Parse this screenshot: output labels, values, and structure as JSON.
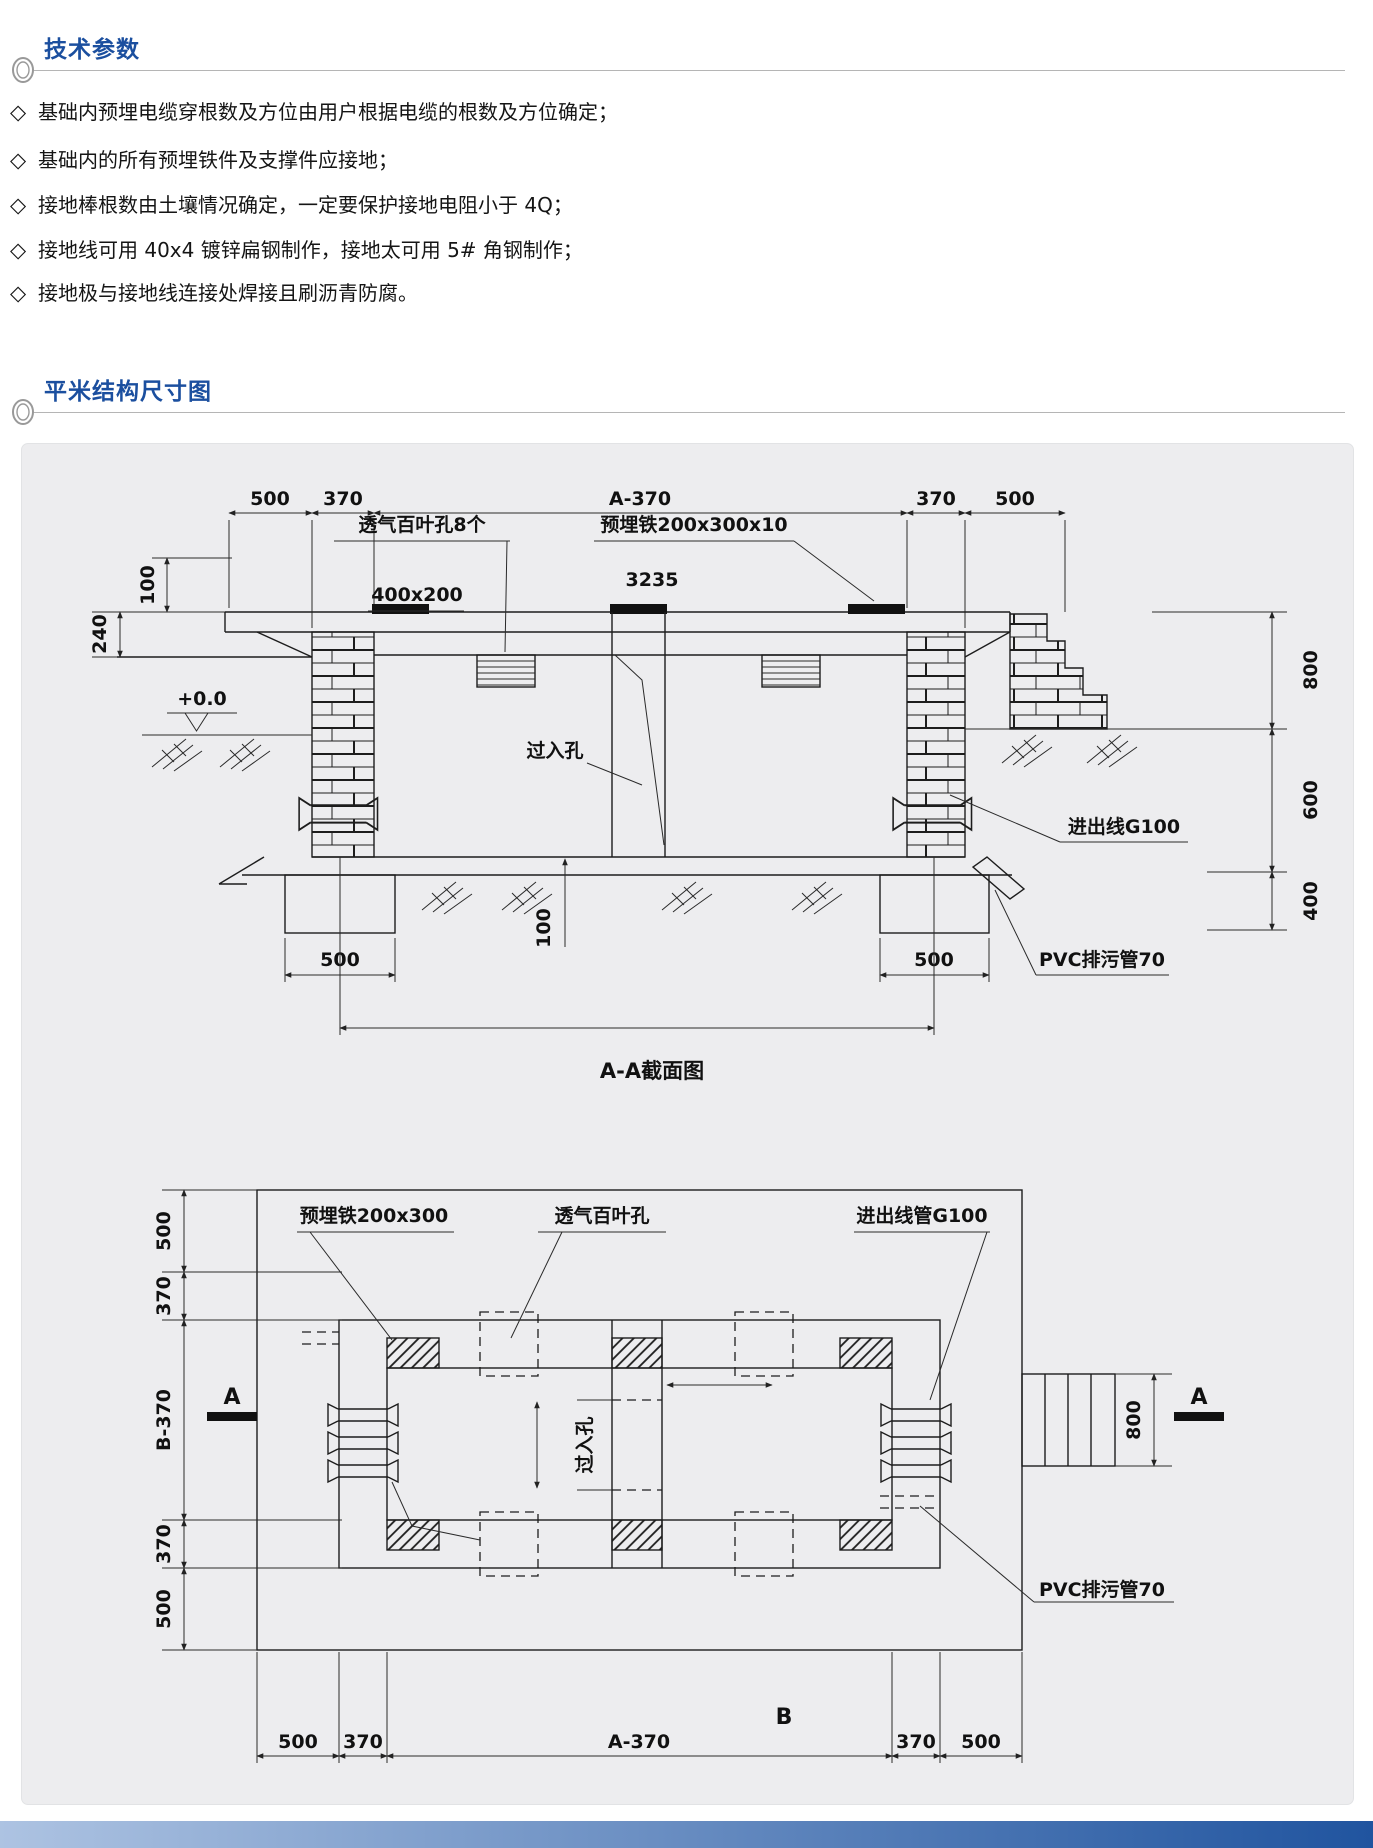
{
  "colors": {
    "title_blue": "#1b4f9f",
    "rule_gray": "#b5b5b5",
    "panel_bg": "#ededef",
    "panel_border": "#e2e3e5",
    "drawing_line": "#1d1d1d",
    "footer_gradient_from": "#adc3e2",
    "footer_gradient_to": "#20549f"
  },
  "sections": {
    "tech_title": "技术参数",
    "structure_title": "平米结构尺寸图"
  },
  "bullet_marker": "◇",
  "bullets": [
    "基础内预埋电缆穿根数及方位由用户根据电缆的根数及方位确定；",
    "基础内的所有预埋铁件及支撑件应接地；",
    "接地棒根数由土壤情况确定，一定要保护接地电阻小于 4Q；",
    "接地线可用 40x4 镀锌扁钢制作，接地太可用 5# 角钢制作；",
    "接地极与接地线连接处焊接且刷沥青防腐。"
  ],
  "section_view": {
    "dims_top": [
      "500",
      "370",
      "A-370",
      "370",
      "500"
    ],
    "dim_left_top": "100",
    "dim_left_mid": "240",
    "label_vent": "透气百叶孔8个",
    "label_iron": "预埋铁200x300x10",
    "dim_3235": "3235",
    "label_cover": "400x200",
    "label_level": "+0.0",
    "label_manhole": "过入孔",
    "label_conduit": "进出线G100",
    "label_pvc": "PVC排污管70",
    "dims_right": [
      "800",
      "600",
      "400"
    ],
    "dim_footing_left": "500",
    "dim_footing_right": "500",
    "dim_floor": "100",
    "caption": "A-A截面图"
  },
  "plan_view": {
    "labels_top": [
      "预埋铁200x300",
      "透气百叶孔",
      "进出线管G100"
    ],
    "dims_left": [
      "500",
      "370",
      "B-370",
      "370",
      "500"
    ],
    "label_manhole": "过入孔",
    "dim_right": "800",
    "marker_left": "A",
    "marker_right": "A",
    "label_pvc": "PVC排污管70",
    "label_b": "B",
    "dims_bottom": [
      "500",
      "370",
      "A-370",
      "370",
      "500"
    ]
  }
}
